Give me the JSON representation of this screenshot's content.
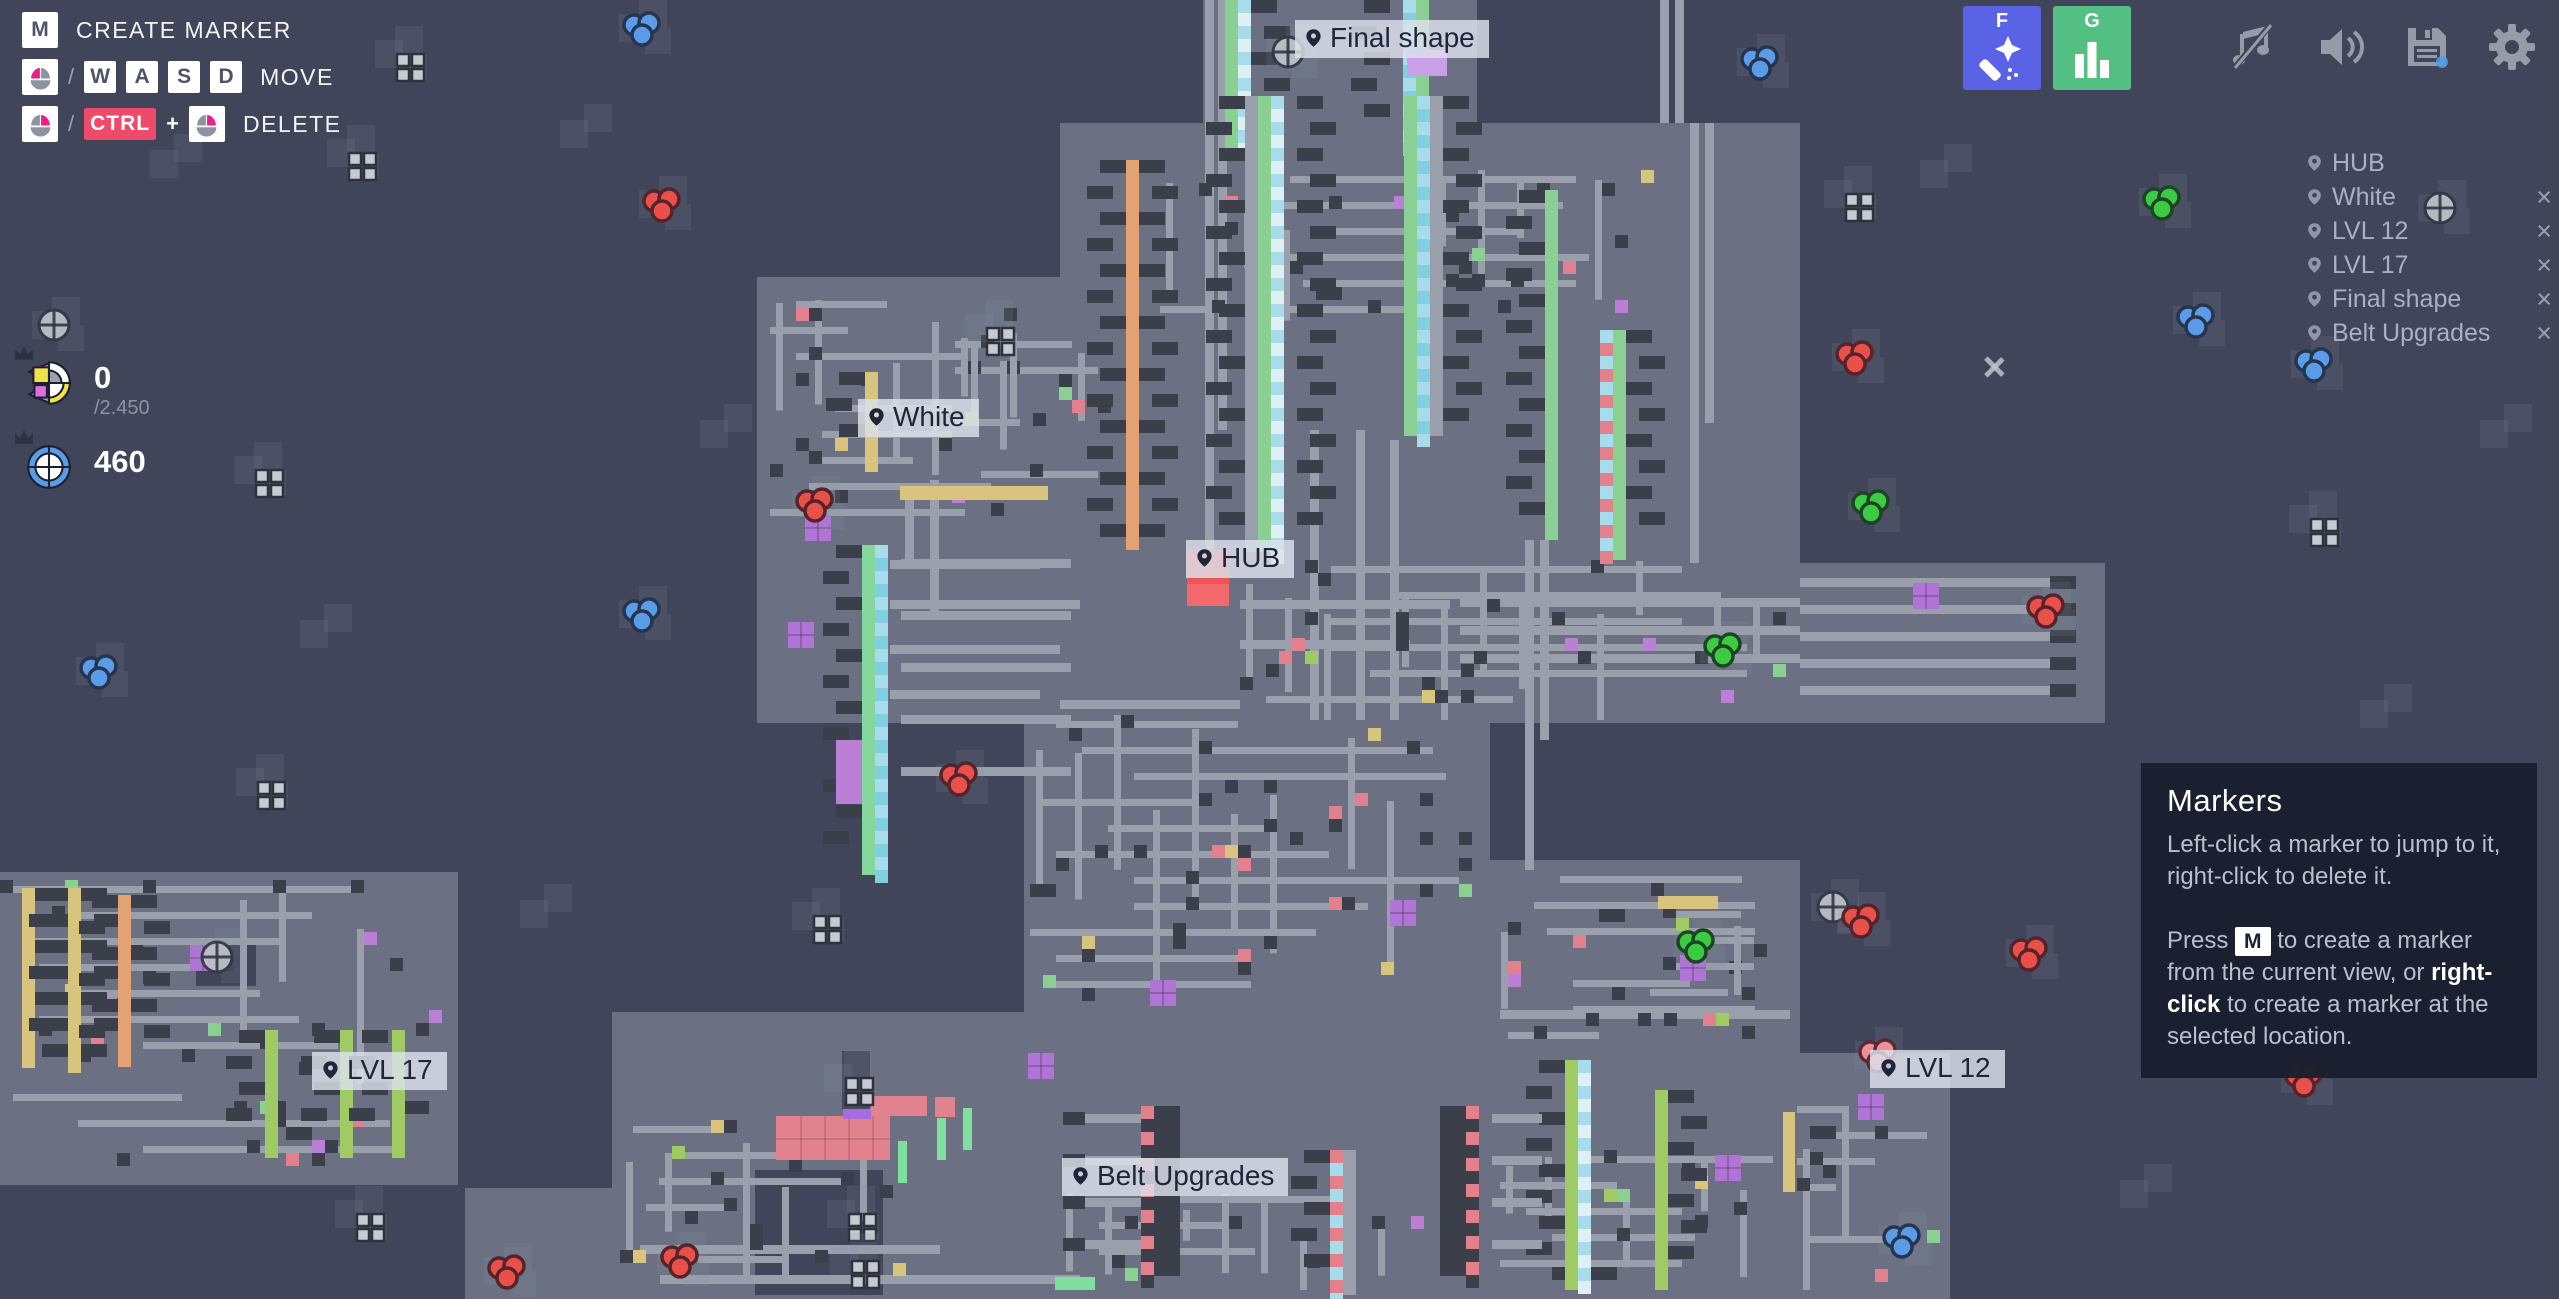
{
  "legend": {
    "rows": [
      {
        "label": "CREATE MARKER"
      },
      {
        "label": "MOVE"
      },
      {
        "label": "DELETE"
      }
    ],
    "key_m": "M",
    "keys_move": [
      "W",
      "A",
      "S",
      "D"
    ],
    "ctrl": "CTRL",
    "slash": "/",
    "plus": "+"
  },
  "pinned": [
    {
      "value": "0",
      "goal": "/2.450",
      "icon": "freeplay-shape"
    },
    {
      "value": "460",
      "goal": "",
      "icon": "blueprint-shape"
    }
  ],
  "topbar": {
    "wand_key": "F",
    "stats_key": "G",
    "wand_color": "#5a63e6",
    "stats_color": "#54bf82"
  },
  "marker_list": [
    {
      "label": "HUB",
      "deletable": false
    },
    {
      "label": "White",
      "deletable": true
    },
    {
      "label": "LVL 12",
      "deletable": true
    },
    {
      "label": "LVL 17",
      "deletable": true
    },
    {
      "label": "Final shape",
      "deletable": true
    },
    {
      "label": "Belt Upgrades",
      "deletable": true
    }
  ],
  "ui": {
    "close": "×"
  },
  "tooltip": {
    "title": "Markers",
    "p1": "Left-click a marker to jump to it, right-click to delete it.",
    "p2_pre": "Press",
    "p2_key": "M",
    "p2_mid": " to create a marker from the current view, or ",
    "p2_bold": "right-click",
    "p2_post": " to create a marker at the selected location."
  },
  "map": {
    "colors": {
      "bg": "#40455a",
      "chunk": "#6b7183",
      "belt": "#999fab",
      "dark": "#3a3f49",
      "shadow": "rgba(140,148,170,0.14)",
      "dot_blue": "#5b9ce8",
      "dot_red": "#e85049",
      "dot_green": "#3ecb44",
      "dot_pink": "#f08f9a",
      "hub_red": "#ef5257",
      "hub_red2": "#f4696c",
      "purple": "#b073d6"
    },
    "labels": [
      {
        "t": "Final shape",
        "x": 1295,
        "y": 20
      },
      {
        "t": "White",
        "x": 858,
        "y": 399
      },
      {
        "t": "HUB",
        "x": 1186,
        "y": 540
      },
      {
        "t": "LVL 17",
        "x": 312,
        "y": 1052
      },
      {
        "t": "LVL 12",
        "x": 1870,
        "y": 1050
      },
      {
        "t": "Belt Upgrades",
        "x": 1062,
        "y": 1158
      }
    ],
    "hub": {
      "x": 1187,
      "y": 550,
      "w": 42,
      "h": 56
    },
    "chunks": [
      [
        1203,
        0,
        274,
        123
      ],
      [
        1060,
        123,
        740,
        600
      ],
      [
        757,
        277,
        303,
        446
      ],
      [
        1800,
        563,
        305,
        160
      ],
      [
        1024,
        723,
        466,
        289
      ],
      [
        1490,
        860,
        310,
        439
      ],
      [
        612,
        1012,
        1183,
        287
      ],
      [
        1795,
        1053,
        155,
        246
      ],
      [
        0,
        872,
        458,
        313
      ],
      [
        465,
        1188,
        147,
        111
      ]
    ],
    "holes": [
      [
        755,
        1170,
        128,
        125
      ],
      [
        196,
        938,
        60,
        48
      ]
    ],
    "shadows": [
      [
        560,
        120
      ],
      [
        1920,
        160
      ],
      [
        2360,
        700
      ],
      [
        300,
        620
      ],
      [
        2120,
        1180
      ],
      [
        520,
        900
      ],
      [
        2480,
        420
      ],
      [
        150,
        150
      ],
      [
        700,
        420
      ],
      [
        2230,
        980
      ]
    ],
    "vbelts": [
      [
        1205,
        0,
        560
      ],
      [
        1218,
        0,
        430
      ],
      [
        1660,
        0,
        123
      ],
      [
        1675,
        0,
        123
      ],
      [
        1310,
        430,
        290
      ],
      [
        1356,
        430,
        290
      ],
      [
        1390,
        440,
        280
      ],
      [
        1690,
        123,
        440
      ],
      [
        1705,
        123,
        300
      ],
      [
        905,
        500,
        60
      ],
      [
        930,
        480,
        140
      ],
      [
        1525,
        540,
        330
      ],
      [
        1540,
        540,
        200
      ]
    ],
    "hbelts": [
      [
        1800,
        578,
        250,
        1
      ],
      [
        1800,
        605,
        250,
        1
      ],
      [
        1800,
        632,
        250,
        1
      ],
      [
        1800,
        659,
        250,
        1
      ],
      [
        1800,
        686,
        250,
        1
      ],
      [
        1460,
        598,
        340,
        0
      ],
      [
        1460,
        626,
        340,
        0
      ],
      [
        1460,
        654,
        340,
        0
      ],
      [
        1240,
        600,
        210,
        0
      ],
      [
        1240,
        640,
        170,
        0
      ],
      [
        890,
        560,
        150,
        0
      ],
      [
        890,
        600,
        190,
        0
      ],
      [
        890,
        645,
        170,
        0
      ],
      [
        890,
        690,
        150,
        0
      ],
      [
        640,
        1245,
        300,
        0
      ],
      [
        660,
        1275,
        420,
        0
      ],
      [
        1500,
        1010,
        290,
        0
      ],
      [
        1060,
        700,
        180,
        0
      ]
    ],
    "mazes": [
      [
        1240,
        560,
        560,
        160,
        11
      ],
      [
        1030,
        715,
        450,
        300,
        22
      ],
      [
        1495,
        870,
        300,
        185,
        33
      ],
      [
        620,
        1120,
        300,
        170,
        44
      ],
      [
        1500,
        1150,
        290,
        140,
        55
      ],
      [
        1797,
        1100,
        148,
        190,
        66
      ],
      [
        955,
        335,
        190,
        160,
        77
      ],
      [
        1060,
        1190,
        380,
        100,
        88
      ],
      [
        770,
        295,
        280,
        235,
        13
      ],
      [
        0,
        880,
        450,
        290,
        7
      ],
      [
        1160,
        170,
        500,
        175,
        101
      ],
      [
        1650,
        905,
        145,
        105,
        19
      ]
    ],
    "factories": [
      {
        "x": 1225,
        "y": 0,
        "h": 150,
        "strips": [
          {
            "o": 0,
            "c": "#8bd093"
          },
          {
            "o": 13,
            "c": "#a8dcea",
            "c2": "#dff0f5",
            "ck": 1
          }
        ],
        "blocks": [
          {
            "o": 26,
            "s": 1
          }
        ]
      },
      {
        "x": 1390,
        "y": 0,
        "h": 150,
        "strips": [
          {
            "o": 13,
            "c": "#a8dcea",
            "c2": "#7fd0e0",
            "ck": 1
          },
          {
            "o": 26,
            "c": "#8bd093"
          }
        ],
        "blocks": [
          {
            "o": -26,
            "s": -1
          }
        ]
      },
      {
        "x": 1245,
        "y": 96,
        "h": 456,
        "strips": [
          {
            "o": 0,
            "c": "#999fab"
          },
          {
            "o": 13,
            "c": "#8bd093"
          },
          {
            "o": 26,
            "c": "#a8dcea",
            "c2": "#dff0f5",
            "ck": 1
          }
        ],
        "blocks": [
          {
            "o": 52,
            "s": 1
          },
          {
            "o": -26,
            "s": -1
          }
        ]
      },
      {
        "x": 1404,
        "y": 96,
        "h": 340,
        "strips": [
          {
            "o": 0,
            "c": "#8bd093"
          },
          {
            "o": 13,
            "c": "#a8dcea",
            "c2": "#7fd0e0",
            "ck": 1
          },
          {
            "o": 26,
            "c": "#999fab"
          }
        ],
        "blocks": [
          {
            "o": 39,
            "s": 1
          }
        ]
      },
      {
        "x": 1545,
        "y": 190,
        "h": 350,
        "strips": [
          {
            "o": 0,
            "c": "#8bd093"
          }
        ],
        "blocks": [
          {
            "o": -26,
            "s": -1
          }
        ]
      },
      {
        "x": 1600,
        "y": 330,
        "h": 230,
        "strips": [
          {
            "o": 0,
            "c": "#a8dcea",
            "c2": "#e2808c",
            "ck": 1
          },
          {
            "o": 13,
            "c": "#8bd093"
          }
        ],
        "blocks": [
          {
            "o": 26,
            "s": 1
          }
        ]
      },
      {
        "x": 1126,
        "y": 160,
        "h": 390,
        "strips": [
          {
            "o": 0,
            "c": "#e2a273"
          }
        ],
        "blocks": [
          {
            "o": -26,
            "s": -1
          },
          {
            "o": 13,
            "s": 1
          }
        ]
      },
      {
        "x": 862,
        "y": 545,
        "h": 330,
        "strips": [
          {
            "o": 0,
            "c": "#86d79b"
          },
          {
            "o": 13,
            "c": "#a8dcea",
            "c2": "#7fd0e0",
            "ck": 1
          }
        ],
        "blocks": [
          {
            "o": -26,
            "s": -1
          }
        ],
        "beltR": {
          "o": 26,
          "len": 170,
          "n": 5,
          "y0": 14,
          "step": 52
        }
      },
      {
        "x": 865,
        "y": 372,
        "h": 100,
        "strips": [
          {
            "o": 0,
            "c": "#d9c47d"
          }
        ],
        "blocks": [
          {
            "o": -26,
            "s": -1
          }
        ]
      },
      {
        "x": 22,
        "y": 888,
        "h": 180,
        "strips": [
          {
            "o": 0,
            "c": "#d9c47d"
          }
        ],
        "blocks": [
          {
            "o": 13,
            "s": 1
          }
        ]
      },
      {
        "x": 68,
        "y": 888,
        "h": 185,
        "strips": [
          {
            "o": 0,
            "c": "#d9c47d"
          }
        ],
        "blocks": [
          {
            "o": -26,
            "s": -1
          },
          {
            "o": 13,
            "s": 1
          }
        ]
      },
      {
        "x": 118,
        "y": 895,
        "h": 172,
        "strips": [
          {
            "o": 0,
            "c": "#e2a273"
          }
        ],
        "blocks": [
          {
            "o": -26,
            "s": -1
          },
          {
            "o": 13,
            "s": 1
          }
        ]
      },
      {
        "x": 265,
        "y": 1030,
        "h": 128,
        "strips": [
          {
            "o": 0,
            "c": "#9ecb63"
          }
        ],
        "blocks": [
          {
            "o": -26,
            "s": -1
          }
        ]
      },
      {
        "x": 340,
        "y": 1030,
        "h": 128,
        "strips": [
          {
            "o": 0,
            "c": "#9ecb63"
          }
        ],
        "blocks": [
          {
            "o": -26,
            "s": -1
          }
        ]
      },
      {
        "x": 392,
        "y": 1030,
        "h": 128,
        "strips": [
          {
            "o": 0,
            "c": "#9ecb63"
          }
        ],
        "blocks": [
          {
            "o": -30,
            "s": -1
          }
        ]
      },
      {
        "x": 1565,
        "y": 1060,
        "h": 230,
        "strips": [
          {
            "o": 0,
            "c": "#9ecb63"
          },
          {
            "o": 13,
            "c": "#a8dcea",
            "c2": "#dff0f5",
            "ck": 1
          }
        ],
        "blocks": [
          {
            "o": -26,
            "s": -1
          }
        ]
      },
      {
        "x": 1655,
        "y": 1090,
        "h": 200,
        "strips": [
          {
            "o": 0,
            "c": "#9ecb63"
          }
        ],
        "blocks": [
          {
            "o": 13,
            "s": 1
          }
        ]
      },
      {
        "x": 1330,
        "y": 1150,
        "h": 145,
        "strips": [
          {
            "o": 0,
            "c": "#e2808c",
            "c2": "#a8dcea",
            "ck": 1
          },
          {
            "o": 13,
            "c": "#999fab"
          }
        ],
        "blocks": [
          {
            "o": -26,
            "s": -1
          }
        ]
      },
      {
        "x": 1141,
        "y": 1106,
        "h": 170,
        "strips": [
          {
            "o": 0,
            "c": "#e2808c",
            "c2": "#3a3f49",
            "ck": 1
          },
          {
            "o": 13,
            "c": "#3a3f49",
            "w": 26
          }
        ],
        "beltL": {
          "len": 56,
          "n": 4,
          "y0": 8,
          "step": 42
        }
      },
      {
        "x": 1440,
        "y": 1106,
        "h": 170,
        "strips": [
          {
            "o": 0,
            "c": "#3a3f49",
            "w": 26
          },
          {
            "o": 26,
            "c": "#e2808c",
            "c2": "#3a3f49",
            "ck": 1
          }
        ],
        "beltR": {
          "o": 39,
          "len": 50,
          "n": 4,
          "y0": 8,
          "step": 42
        }
      }
    ],
    "rects": [
      [
        900,
        486,
        148,
        14,
        "#d9c47d"
      ],
      [
        776,
        1116,
        114,
        44,
        "#e2828e"
      ],
      [
        871,
        1096,
        56,
        20,
        "#e2828e"
      ],
      [
        935,
        1097,
        20,
        20,
        "#e2828e"
      ],
      [
        843,
        1107,
        28,
        12,
        "#a86be0"
      ],
      [
        937,
        1118,
        9,
        42,
        "#7fdf9e"
      ],
      [
        963,
        1108,
        9,
        42,
        "#7fdf9e"
      ],
      [
        898,
        1141,
        9,
        42,
        "#7fdf9e"
      ],
      [
        842,
        1051,
        28,
        58,
        "#454a5c"
      ],
      [
        1055,
        1277,
        40,
        13,
        "#7fdf9e"
      ],
      [
        1658,
        896,
        60,
        13,
        "#d9c47d"
      ],
      [
        1783,
        1112,
        12,
        80,
        "#d9c47d"
      ],
      [
        836,
        740,
        26,
        64,
        "#bb7fd6"
      ],
      [
        1407,
        50,
        40,
        26,
        "#c9a0e8"
      ]
    ],
    "purples": [
      [
        805,
        515
      ],
      [
        788,
        622
      ],
      [
        1028,
        1053
      ],
      [
        1858,
        1094
      ],
      [
        1680,
        955
      ],
      [
        1150,
        980
      ],
      [
        1390,
        900
      ],
      [
        190,
        945
      ],
      [
        1913,
        583
      ],
      [
        1715,
        1155
      ]
    ],
    "windows": [
      [
        397,
        54
      ],
      [
        349,
        153
      ],
      [
        1846,
        194
      ],
      [
        987,
        328
      ],
      [
        256,
        470
      ],
      [
        2311,
        519
      ],
      [
        814,
        916
      ],
      [
        849,
        1214
      ],
      [
        357,
        1214
      ],
      [
        852,
        1261
      ],
      [
        258,
        782
      ],
      [
        846,
        1078
      ]
    ],
    "circles": [
      [
        54,
        325
      ],
      [
        1288,
        52
      ],
      [
        217,
        957
      ],
      [
        1833,
        907
      ],
      [
        2440,
        208
      ]
    ],
    "sparkles": [
      [
        1994,
        367
      ]
    ],
    "dots": [
      {
        "c": "blue",
        "x": 641,
        "y": 28
      },
      {
        "c": "blue",
        "x": 1759,
        "y": 62
      },
      {
        "c": "blue",
        "x": 2195,
        "y": 320
      },
      {
        "c": "blue",
        "x": 2313,
        "y": 364
      },
      {
        "c": "blue",
        "x": 641,
        "y": 614
      },
      {
        "c": "blue",
        "x": 98,
        "y": 671
      },
      {
        "c": "blue",
        "x": 1901,
        "y": 1240
      },
      {
        "c": "red",
        "x": 661,
        "y": 204
      },
      {
        "c": "red",
        "x": 1854,
        "y": 357
      },
      {
        "c": "red",
        "x": 814,
        "y": 504
      },
      {
        "c": "red",
        "x": 958,
        "y": 778
      },
      {
        "c": "red",
        "x": 2045,
        "y": 610
      },
      {
        "c": "red",
        "x": 1860,
        "y": 920
      },
      {
        "c": "red",
        "x": 2028,
        "y": 953
      },
      {
        "c": "red",
        "x": 2303,
        "y": 1079
      },
      {
        "c": "red",
        "x": 506,
        "y": 1271
      },
      {
        "c": "red",
        "x": 679,
        "y": 1260
      },
      {
        "c": "pink",
        "x": 1877,
        "y": 1055
      },
      {
        "c": "green",
        "x": 2161,
        "y": 202
      },
      {
        "c": "green",
        "x": 1870,
        "y": 506
      },
      {
        "c": "green",
        "x": 1722,
        "y": 649
      },
      {
        "c": "green",
        "x": 1695,
        "y": 945
      }
    ]
  }
}
